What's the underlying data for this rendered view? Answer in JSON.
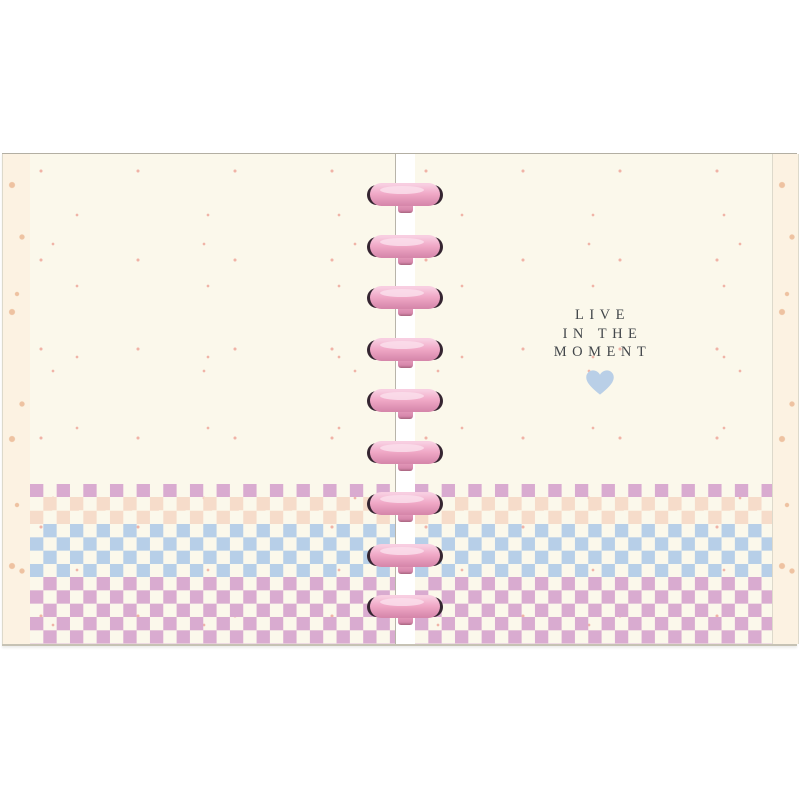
{
  "scene": {
    "description": "Open disc-bound planner notebook mockup on white background",
    "background_color": "#ffffff"
  },
  "notebook": {
    "page_color": "#fbf8eb",
    "page_dot_color": "#f0b3a6",
    "cover_strip_color": "#fcf2e2",
    "cover_dot_color": "#eec2a1",
    "edge_line_color": "#b3afa3",
    "edge_bottom_color": "#c6c2b4",
    "edge_soft_color": "#ddd9cb",
    "spine_line_color": "#b8b4a9",
    "discs": {
      "count": 9,
      "color_light": "#f8cee1",
      "color_main": "#f0a8c6",
      "color_dark": "#d687ab",
      "color_deep": "#a8657f",
      "color_tip": "#352531",
      "color_shine": "#fadeeb"
    },
    "quote": {
      "line1": "LIVE",
      "line2": "IN THE",
      "line3": "MOMENT",
      "text_color": "#43474b",
      "heart_icon": "heart",
      "heart_color": "#b9cfe7"
    },
    "checker": {
      "cell_size_px": 13.333,
      "bands": [
        {
          "name": "mauve",
          "color": "#d9abd0",
          "rows": 1
        },
        {
          "name": "peach",
          "color": "#f6dcca",
          "rows": 2
        },
        {
          "name": "blue",
          "color": "#b7cfe8",
          "rows": 4
        },
        {
          "name": "mauve",
          "color": "#d9abd0",
          "rows": 5
        }
      ]
    }
  }
}
